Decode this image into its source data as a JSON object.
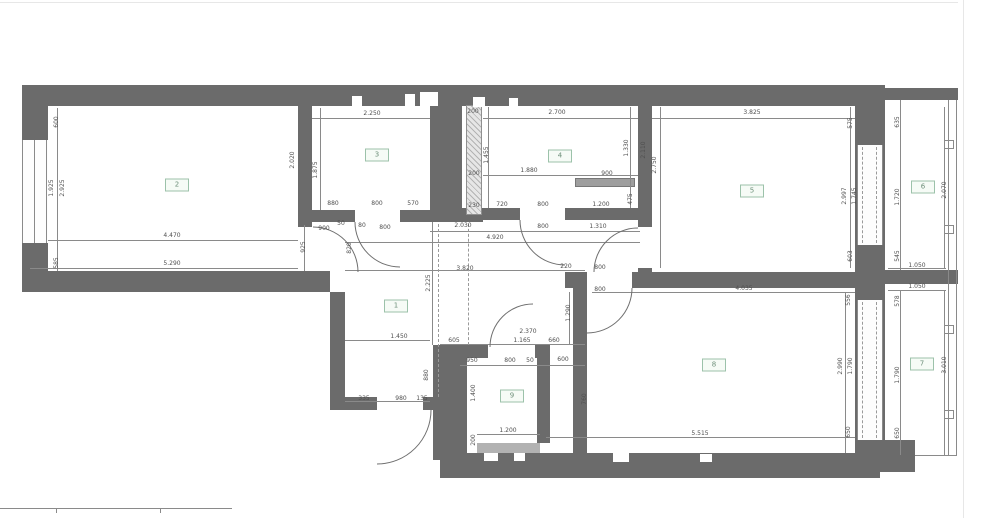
{
  "drawing": {
    "kind": "apartment floor plan",
    "colors": {
      "wall": "#6b6b6b",
      "dim_line": "#8a8a8a",
      "dim_text": "#4f4f4f",
      "room_label_border": "#9cc2aa",
      "room_label_text": "#6d8f79",
      "hatch_fill": "#b3b3b3",
      "vent_bar": "#9e9e9e",
      "threshold": "#b2b2b2"
    },
    "rooms": [
      {
        "number": "1",
        "cx": 396,
        "cy": 306
      },
      {
        "number": "2",
        "cx": 177,
        "cy": 185
      },
      {
        "number": "3",
        "cx": 377,
        "cy": 155
      },
      {
        "number": "4",
        "cx": 560,
        "cy": 156
      },
      {
        "number": "5",
        "cx": 752,
        "cy": 191
      },
      {
        "number": "6",
        "cx": 923,
        "cy": 187
      },
      {
        "number": "7",
        "cx": 922,
        "cy": 364
      },
      {
        "number": "8",
        "cx": 714,
        "cy": 365
      },
      {
        "number": "9",
        "cx": 512,
        "cy": 396
      }
    ],
    "dimensions": [
      {
        "t": "600",
        "x": 57,
        "y": 122,
        "r": 90
      },
      {
        "t": "1.925",
        "x": 52,
        "y": 188,
        "r": 90
      },
      {
        "t": "2.925",
        "x": 63,
        "y": 188,
        "r": 90
      },
      {
        "t": "585",
        "x": 57,
        "y": 263,
        "r": 90
      },
      {
        "t": "4.470",
        "x": 172,
        "y": 236,
        "r": 0
      },
      {
        "t": "5.290",
        "x": 172,
        "y": 264,
        "r": 0
      },
      {
        "t": "925",
        "x": 304,
        "y": 247,
        "r": 90
      },
      {
        "t": "2.250",
        "x": 372,
        "y": 114,
        "r": 0
      },
      {
        "t": "2.020",
        "x": 293,
        "y": 160,
        "r": 90
      },
      {
        "t": "1.875",
        "x": 316,
        "y": 170,
        "r": 90
      },
      {
        "t": "880",
        "x": 333,
        "y": 204,
        "r": 0
      },
      {
        "t": "800",
        "x": 377,
        "y": 204,
        "r": 0
      },
      {
        "t": "570",
        "x": 413,
        "y": 204,
        "r": 0
      },
      {
        "t": "900",
        "x": 324,
        "y": 229,
        "r": 0
      },
      {
        "t": "50",
        "x": 341,
        "y": 224,
        "r": 0
      },
      {
        "t": "80",
        "x": 362,
        "y": 226,
        "r": 0
      },
      {
        "t": "800",
        "x": 385,
        "y": 228,
        "r": 0
      },
      {
        "t": "820",
        "x": 350,
        "y": 248,
        "r": 90
      },
      {
        "t": "200",
        "x": 473,
        "y": 112,
        "r": 0
      },
      {
        "t": "200",
        "x": 474,
        "y": 174,
        "r": 0
      },
      {
        "t": "230",
        "x": 474,
        "y": 206,
        "r": 0
      },
      {
        "t": "1.455",
        "x": 487,
        "y": 155,
        "r": 90
      },
      {
        "t": "2.700",
        "x": 557,
        "y": 113,
        "r": 0
      },
      {
        "t": "1.880",
        "x": 529,
        "y": 171,
        "r": 0
      },
      {
        "t": "900",
        "x": 607,
        "y": 174,
        "r": 0
      },
      {
        "t": "475",
        "x": 631,
        "y": 199,
        "r": 90
      },
      {
        "t": "1.330",
        "x": 627,
        "y": 148,
        "r": 90
      },
      {
        "t": "2.110",
        "x": 644,
        "y": 150,
        "r": 90
      },
      {
        "t": "720",
        "x": 502,
        "y": 205,
        "r": 0
      },
      {
        "t": "800",
        "x": 543,
        "y": 205,
        "r": 0
      },
      {
        "t": "1.200",
        "x": 601,
        "y": 205,
        "r": 0
      },
      {
        "t": "2.030",
        "x": 463,
        "y": 226,
        "r": 0
      },
      {
        "t": "800",
        "x": 543,
        "y": 227,
        "r": 0
      },
      {
        "t": "1.310",
        "x": 598,
        "y": 227,
        "r": 0
      },
      {
        "t": "4.920",
        "x": 495,
        "y": 238,
        "r": 0
      },
      {
        "t": "3.820",
        "x": 465,
        "y": 269,
        "r": 0
      },
      {
        "t": "2.225",
        "x": 429,
        "y": 283,
        "r": 90
      },
      {
        "t": "3.825",
        "x": 752,
        "y": 113,
        "r": 0
      },
      {
        "t": "2.750",
        "x": 655,
        "y": 165,
        "r": 90
      },
      {
        "t": "575",
        "x": 851,
        "y": 123,
        "r": 90
      },
      {
        "t": "2.997",
        "x": 845,
        "y": 196,
        "r": 90
      },
      {
        "t": "1.745",
        "x": 855,
        "y": 196,
        "r": 90
      },
      {
        "t": "603",
        "x": 851,
        "y": 256,
        "r": 90
      },
      {
        "t": "635",
        "x": 898,
        "y": 122,
        "r": 90
      },
      {
        "t": "1.720",
        "x": 898,
        "y": 197,
        "r": 90
      },
      {
        "t": "545",
        "x": 898,
        "y": 256,
        "r": 90
      },
      {
        "t": "2.070",
        "x": 945,
        "y": 190,
        "r": 90
      },
      {
        "t": "1.050",
        "x": 917,
        "y": 266,
        "r": 0
      },
      {
        "t": "1.050",
        "x": 917,
        "y": 287,
        "r": 0
      },
      {
        "t": "578",
        "x": 898,
        "y": 301,
        "r": 90
      },
      {
        "t": "1.790",
        "x": 898,
        "y": 375,
        "r": 90
      },
      {
        "t": "650",
        "x": 898,
        "y": 433,
        "r": 90
      },
      {
        "t": "3.010",
        "x": 945,
        "y": 365,
        "r": 90
      },
      {
        "t": "4.035",
        "x": 744,
        "y": 289,
        "r": 0
      },
      {
        "t": "556",
        "x": 849,
        "y": 300,
        "r": 90
      },
      {
        "t": "2.990",
        "x": 841,
        "y": 366,
        "r": 90
      },
      {
        "t": "1.790",
        "x": 851,
        "y": 366,
        "r": 90
      },
      {
        "t": "650",
        "x": 849,
        "y": 432,
        "r": 90
      },
      {
        "t": "5.515",
        "x": 700,
        "y": 434,
        "r": 0
      },
      {
        "t": "1.290",
        "x": 569,
        "y": 313,
        "r": 90
      },
      {
        "t": "220",
        "x": 566,
        "y": 267,
        "r": 0
      },
      {
        "t": "800",
        "x": 600,
        "y": 268,
        "r": 0
      },
      {
        "t": "800",
        "x": 600,
        "y": 290,
        "r": 0
      },
      {
        "t": "1.450",
        "x": 399,
        "y": 337,
        "r": 0
      },
      {
        "t": "605",
        "x": 454,
        "y": 341,
        "r": 0
      },
      {
        "t": "2.370",
        "x": 528,
        "y": 332,
        "r": 0
      },
      {
        "t": "1.165",
        "x": 522,
        "y": 341,
        "r": 0
      },
      {
        "t": "660",
        "x": 554,
        "y": 341,
        "r": 0
      },
      {
        "t": "880",
        "x": 427,
        "y": 375,
        "r": 90
      },
      {
        "t": "335",
        "x": 364,
        "y": 399,
        "r": 0
      },
      {
        "t": "980",
        "x": 401,
        "y": 399,
        "r": 0
      },
      {
        "t": "135",
        "x": 422,
        "y": 399,
        "r": 0
      },
      {
        "t": "950",
        "x": 472,
        "y": 361,
        "r": 0
      },
      {
        "t": "800",
        "x": 510,
        "y": 361,
        "r": 0
      },
      {
        "t": "50",
        "x": 530,
        "y": 361,
        "r": 0
      },
      {
        "t": "600",
        "x": 563,
        "y": 360,
        "r": 0
      },
      {
        "t": "1.400",
        "x": 474,
        "y": 393,
        "r": 90
      },
      {
        "t": "1.200",
        "x": 508,
        "y": 431,
        "r": 0
      },
      {
        "t": "200",
        "x": 474,
        "y": 440,
        "r": 90
      },
      {
        "t": "760",
        "x": 585,
        "y": 399,
        "r": 90
      }
    ]
  }
}
